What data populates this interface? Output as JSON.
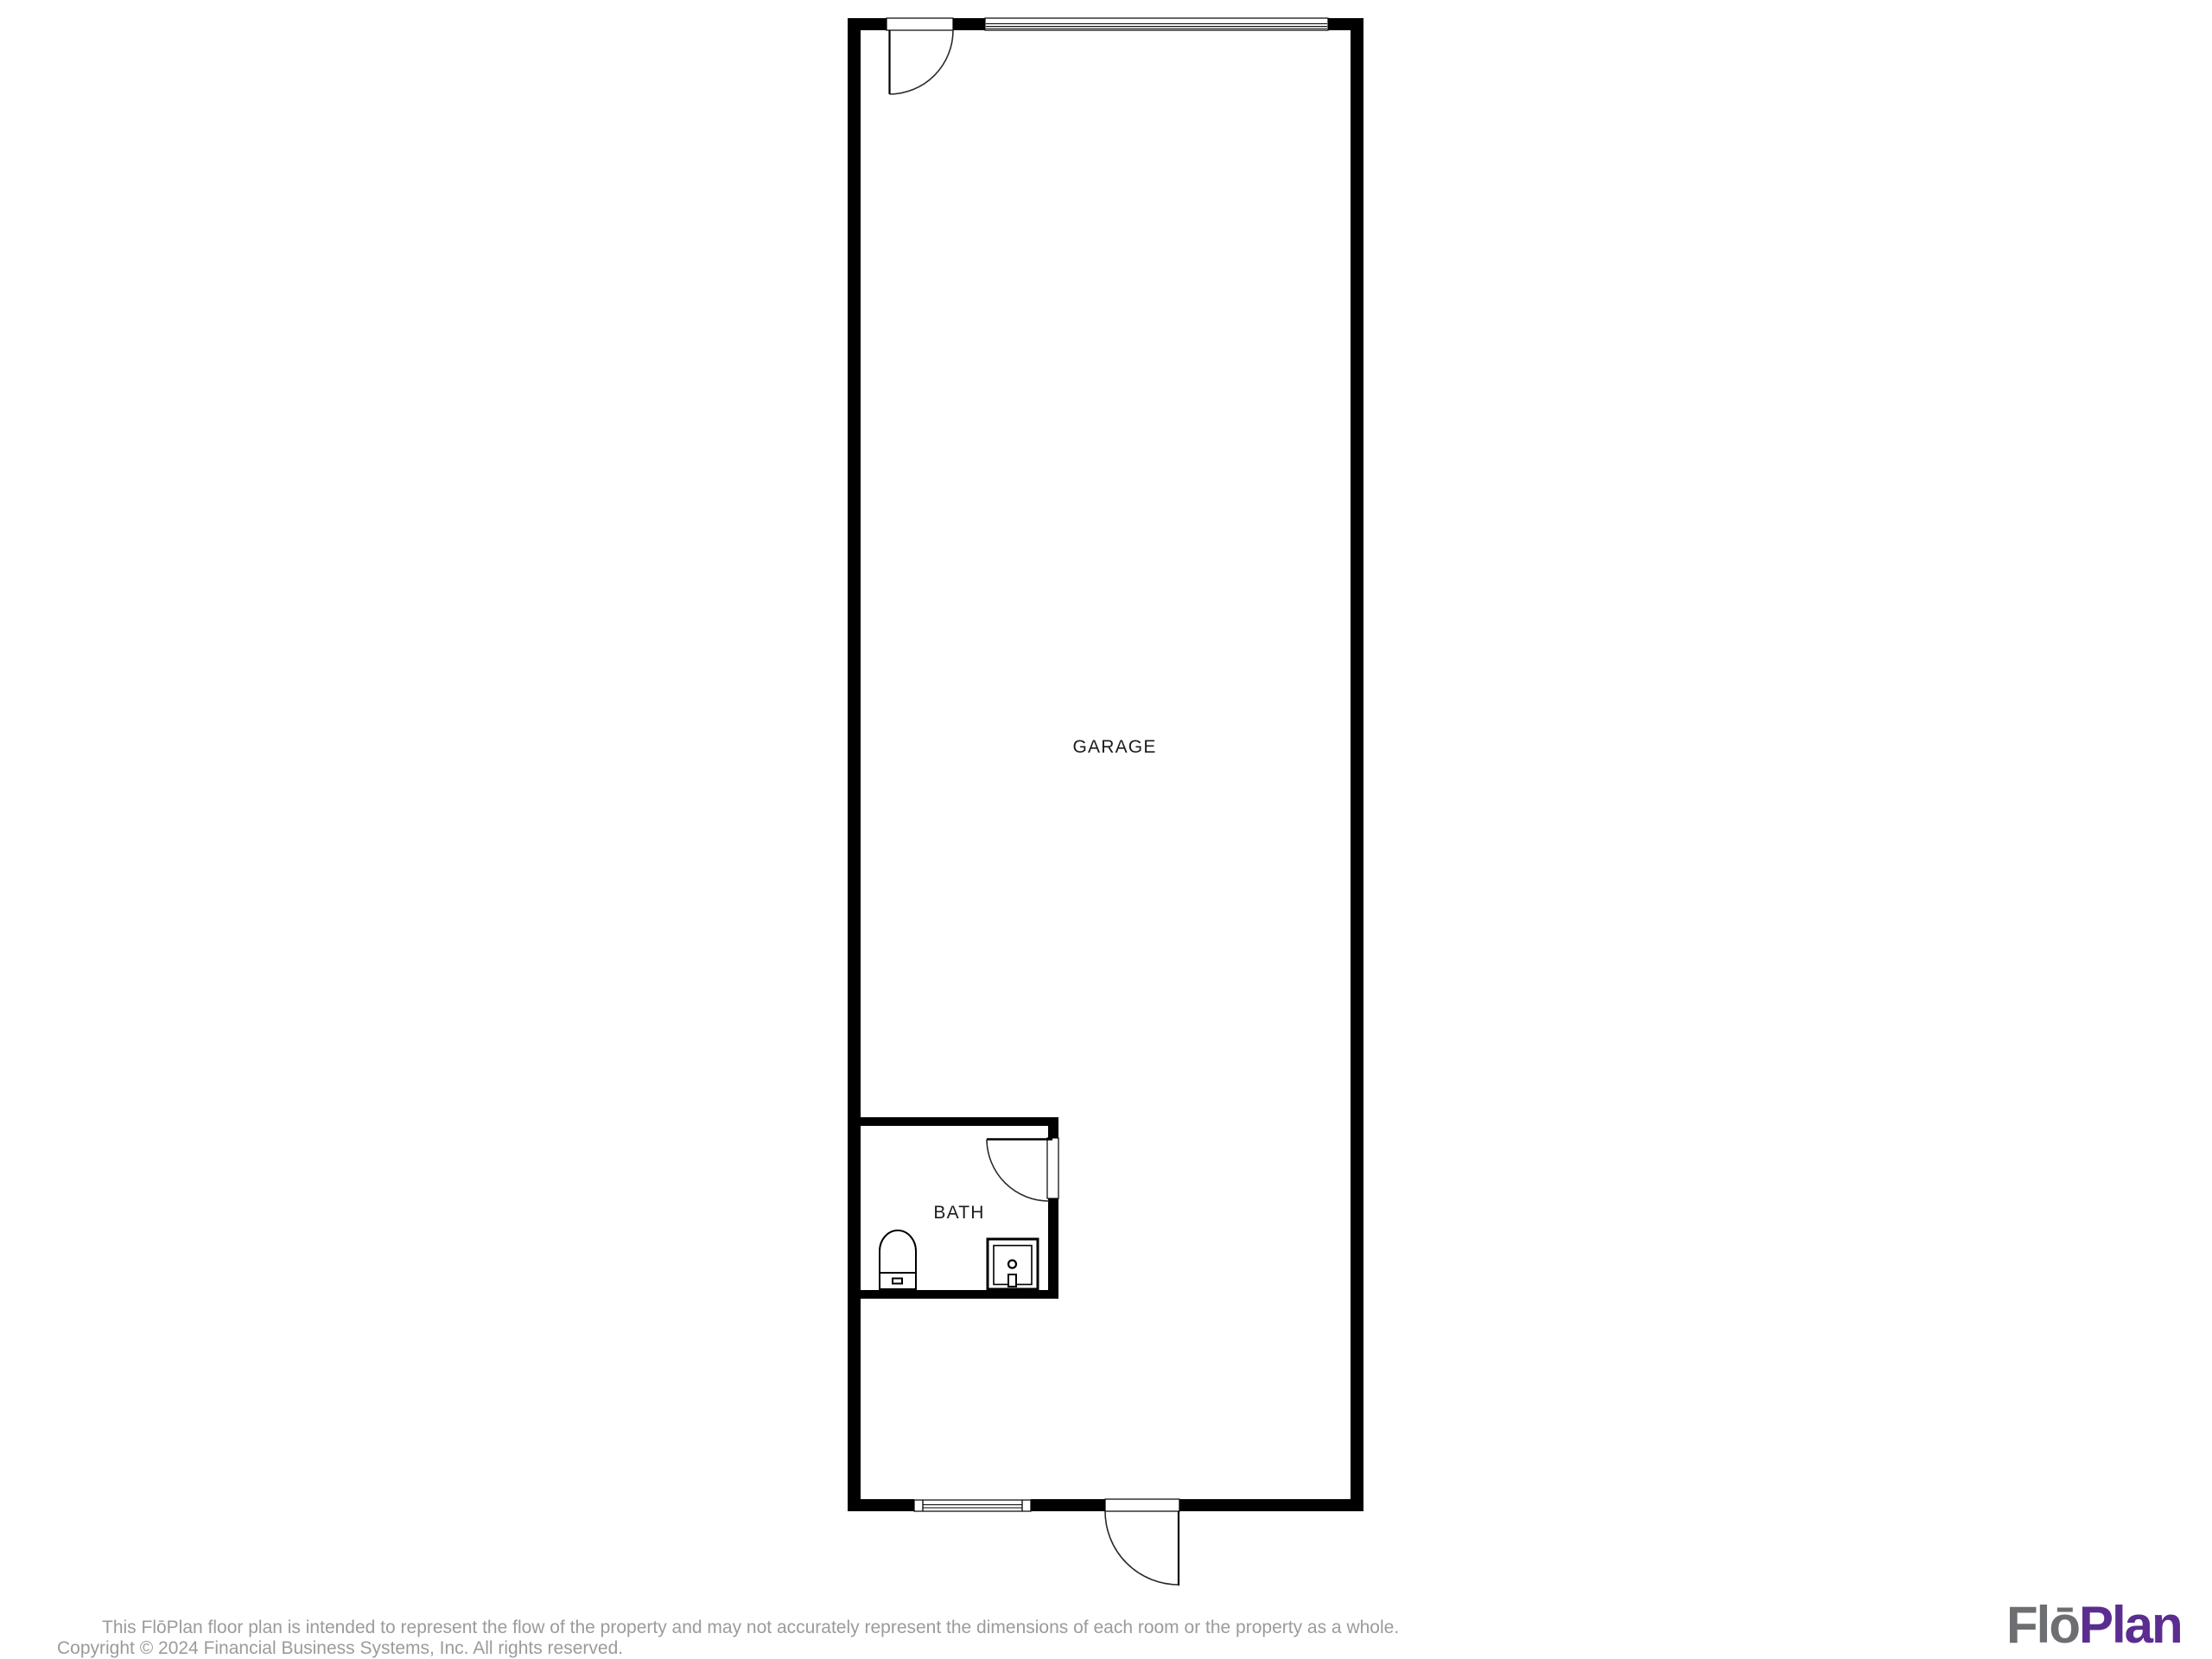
{
  "floor_plan": {
    "garage_label": "GARAGE",
    "bath_label": "BATH",
    "wall_color": "#000000",
    "room_label_color": "#1c1c1c",
    "features": [
      "garage-door",
      "entry-door",
      "bath-door",
      "exterior-door",
      "window"
    ],
    "fixtures": [
      "toilet",
      "sink"
    ]
  },
  "footer": {
    "disclaimer": "This FlōPlan floor plan is intended to represent the flow of the property and may not accurately represent the dimensions of each room or the property as a whole.",
    "copyright": "Copyright © 2024 Financial Business Systems, Inc. All rights reserved.",
    "text_color": "#9b9b9b"
  },
  "logo": {
    "flo": "Flō",
    "plan": "Plan",
    "flo_color": "#6d6e71",
    "plan_color": "#5b2d91"
  }
}
